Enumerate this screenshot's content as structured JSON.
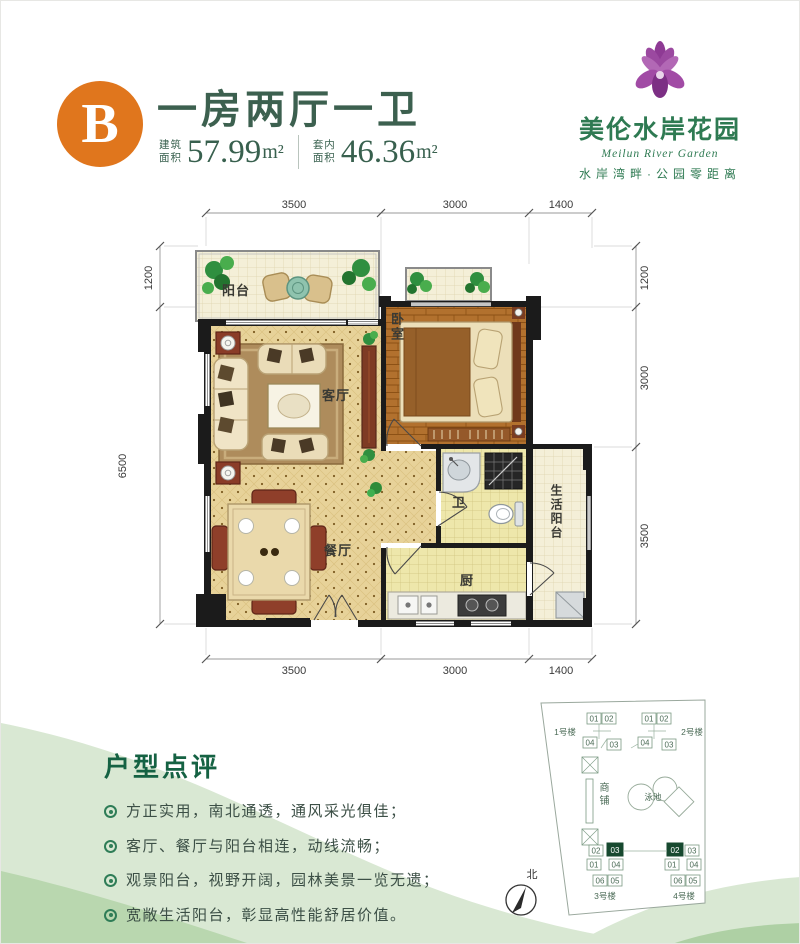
{
  "header": {
    "badge": "B",
    "title": "一房两厅一卫",
    "area_built": {
      "label_line1": "建筑",
      "label_line2": "面积",
      "value": "57.99",
      "unit": "m²"
    },
    "area_inner": {
      "label_line1": "套内",
      "label_line2": "面积",
      "value": "46.36",
      "unit": "m²"
    }
  },
  "logo": {
    "name": "美伦水岸花园",
    "english": "Meilun River Garden",
    "tagline": "水岸湾畔·公园零距离"
  },
  "floorplan": {
    "dim_top": [
      "3500",
      "3000",
      "1400"
    ],
    "dim_bottom": [
      "3500",
      "3000",
      "1400"
    ],
    "dim_left": [
      "1200",
      "6500"
    ],
    "dim_right": [
      "1200",
      "3000",
      "3500"
    ],
    "rooms": {
      "balcony": "阳台",
      "living": "客厅",
      "bedroom": "卧室",
      "dining": "餐厅",
      "bath": "卫",
      "kitchen": "厨",
      "service_balcony": "生活阳台"
    }
  },
  "review": {
    "title": "户型点评",
    "points": [
      "方正实用，南北通透，通风采光俱佳；",
      "客厅、餐厅与阳台相连，动线流畅；",
      "观景阳台，视野开阔，园林美景一览无遗；",
      "宽敞生活阳台，彰显高性能舒居价值。"
    ]
  },
  "siteplan": {
    "building1": {
      "name": "1号楼",
      "units": [
        "01",
        "02",
        "04",
        "03"
      ]
    },
    "building2": {
      "name": "2号楼",
      "units": [
        "01",
        "02",
        "04",
        "03"
      ]
    },
    "building3": {
      "name": "3号楼",
      "units": [
        "02",
        "03",
        "01",
        "04",
        "06",
        "05"
      ],
      "highlighted_unit": "03"
    },
    "building4": {
      "name": "4号楼",
      "units": [
        "02",
        "03",
        "01",
        "04",
        "06",
        "05"
      ],
      "highlighted_unit": "02"
    },
    "shops": "商铺",
    "pool": "泳池",
    "north_label": "北"
  },
  "colors": {
    "accent_orange": "#e0761d",
    "brand_green": "#2e6b4f",
    "logo_purple": "#943d97",
    "highlight_green": "#17492f"
  }
}
